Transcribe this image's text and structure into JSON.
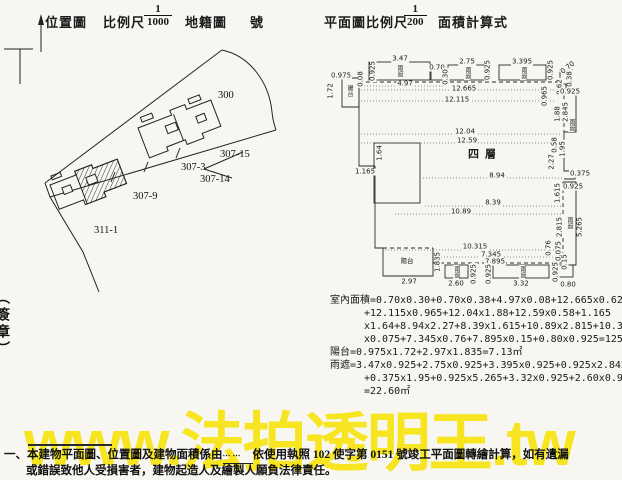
{
  "header": {
    "north_label": "N",
    "location_map_label": "位置圖",
    "scale_label": "比例尺",
    "scale1": {
      "num": "1",
      "den": "1000"
    },
    "cadastral_label": "地籍圖",
    "number_label": "號",
    "plan_scale_label": "平面圖比例尺",
    "scale2": {
      "num": "1",
      "den": "200"
    },
    "area_calc_label": "面積計算式"
  },
  "site_map": {
    "parcels": [
      "300",
      "307-15",
      "307-14",
      "307-3",
      "307-9",
      "311-1"
    ]
  },
  "floor_plan": {
    "floor_label": "四層",
    "labels": [
      {
        "t": "0.975",
        "x": 16,
        "y": 21,
        "k": "h"
      },
      {
        "t": "1.72",
        "x": 6,
        "y": 36,
        "k": "v"
      },
      {
        "t": "陽台",
        "x": 24,
        "y": 36,
        "k": "c"
      },
      {
        "t": "0.08",
        "x": 36,
        "y": 24,
        "k": "v"
      },
      {
        "t": "0.925",
        "x": 48,
        "y": 16,
        "k": "v"
      },
      {
        "t": "3.47",
        "x": 75,
        "y": 4,
        "k": "h"
      },
      {
        "t": "雨遮",
        "x": 74,
        "y": 16,
        "k": "c"
      },
      {
        "t": "4.97",
        "x": 80,
        "y": 29,
        "k": "h"
      },
      {
        "t": "0.70",
        "x": 112,
        "y": 13,
        "k": "h"
      },
      {
        "t": "0.30",
        "x": 121,
        "y": 22,
        "k": "v"
      },
      {
        "t": "2.75",
        "x": 142,
        "y": 7,
        "k": "h"
      },
      {
        "t": "雨遮",
        "x": 142,
        "y": 18,
        "k": "c"
      },
      {
        "t": "0.925",
        "x": 163,
        "y": 15,
        "k": "v"
      },
      {
        "t": "3.395",
        "x": 197,
        "y": 7,
        "k": "h"
      },
      {
        "t": "雨遮",
        "x": 198,
        "y": 18,
        "k": "c"
      },
      {
        "t": "0.925",
        "x": 226,
        "y": 15,
        "k": "v"
      },
      {
        "t": "0.70",
        "x": 243,
        "y": 13,
        "k": "d"
      },
      {
        "t": "0.38",
        "x": 245,
        "y": 24,
        "k": "v"
      },
      {
        "t": "12.665",
        "x": 139,
        "y": 34,
        "k": "h"
      },
      {
        "t": "12.115",
        "x": 132,
        "y": 45,
        "k": "h"
      },
      {
        "t": "0.62",
        "x": 235,
        "y": 32,
        "k": "v"
      },
      {
        "t": "0.965",
        "x": 220,
        "y": 41,
        "k": "v"
      },
      {
        "t": "0.925",
        "x": 245,
        "y": 37,
        "k": "h"
      },
      {
        "t": "1.88",
        "x": 233,
        "y": 59,
        "k": "v"
      },
      {
        "t": "2.845",
        "x": 241,
        "y": 57,
        "k": "v"
      },
      {
        "t": "雨遮",
        "x": 246,
        "y": 70,
        "k": "c"
      },
      {
        "t": "12.04",
        "x": 140,
        "y": 77,
        "k": "h"
      },
      {
        "t": "12.59",
        "x": 142,
        "y": 86,
        "k": "h"
      },
      {
        "t": "0.58",
        "x": 230,
        "y": 90,
        "k": "v"
      },
      {
        "t": "1.95",
        "x": 238,
        "y": 94,
        "k": "v"
      },
      {
        "t": "四層",
        "x": 160,
        "y": 99,
        "k": "big"
      },
      {
        "t": "2.27",
        "x": 227,
        "y": 107,
        "k": "v"
      },
      {
        "t": "0.375",
        "x": 255,
        "y": 119,
        "k": "h"
      },
      {
        "t": "0.925",
        "x": 248,
        "y": 132,
        "k": "h"
      },
      {
        "t": "1.64",
        "x": 55,
        "y": 98,
        "k": "v"
      },
      {
        "t": "1.165",
        "x": 40,
        "y": 117,
        "k": "h"
      },
      {
        "t": "8.94",
        "x": 172,
        "y": 121,
        "k": "h"
      },
      {
        "t": "1.615",
        "x": 233,
        "y": 138,
        "k": "v"
      },
      {
        "t": "8.39",
        "x": 168,
        "y": 148,
        "k": "h"
      },
      {
        "t": "10.89",
        "x": 136,
        "y": 157,
        "k": "h"
      },
      {
        "t": "2.815",
        "x": 235,
        "y": 172,
        "k": "v"
      },
      {
        "t": "雨遮",
        "x": 244,
        "y": 168,
        "k": "c"
      },
      {
        "t": "5.265",
        "x": 255,
        "y": 172,
        "k": "v"
      },
      {
        "t": "10.315",
        "x": 150,
        "y": 192,
        "k": "h"
      },
      {
        "t": "0.76",
        "x": 224,
        "y": 193,
        "k": "v"
      },
      {
        "t": "0.075",
        "x": 234,
        "y": 196,
        "k": "v"
      },
      {
        "t": "7.345",
        "x": 166,
        "y": 200,
        "k": "h"
      },
      {
        "t": "7.895",
        "x": 170,
        "y": 207,
        "k": "h"
      },
      {
        "t": "0.15",
        "x": 240,
        "y": 207,
        "k": "v"
      },
      {
        "t": "陽台",
        "x": 82,
        "y": 206,
        "k": "hc"
      },
      {
        "t": "1.835",
        "x": 113,
        "y": 207,
        "k": "v"
      },
      {
        "t": "2.97",
        "x": 84,
        "y": 227,
        "k": "h"
      },
      {
        "t": "雨遮",
        "x": 131,
        "y": 217,
        "k": "c"
      },
      {
        "t": "2.60",
        "x": 131,
        "y": 229,
        "k": "h"
      },
      {
        "t": "0.925",
        "x": 149,
        "y": 219,
        "k": "v"
      },
      {
        "t": "0.925",
        "x": 164,
        "y": 219,
        "k": "v"
      },
      {
        "t": "雨遮",
        "x": 197,
        "y": 217,
        "k": "c"
      },
      {
        "t": "3.32",
        "x": 196,
        "y": 229,
        "k": "h"
      },
      {
        "t": "0.925",
        "x": 231,
        "y": 217,
        "k": "v"
      },
      {
        "t": "0.80",
        "x": 243,
        "y": 230,
        "k": "h"
      }
    ]
  },
  "calculations": {
    "lines": [
      {
        "text": "室內面積=0.70x0.30+0.70x0.38+4.97x0.08+12.665x0.62",
        "indent": false
      },
      {
        "text": "+12.115x0.965+12.04x1.88+12.59x0.58+1.165",
        "indent": true
      },
      {
        "text": "x1.64+8.94x2.27+8.39x1.615+10.89x2.815+10.315",
        "indent": true
      },
      {
        "text": "x0.075+7.345x0.76+7.895x0.15+0.80x0.925=125.",
        "indent": true
      },
      {
        "text": "陽台=0.975x1.72+2.97x1.835=7.13㎡",
        "indent": false
      },
      {
        "text": "雨遮=3.47x0.925+2.75x0.925+3.395x0.925+0.925x2.845",
        "indent": false
      },
      {
        "text": "+0.375x1.95+0.925x5.265+3.32x0.925+2.60x0.925",
        "indent": true
      },
      {
        "text": "=22.60㎡",
        "indent": true
      }
    ]
  },
  "watermark": {
    "text": "www.法拍透明王.tw",
    "color": "#f6e40a"
  },
  "footnote": {
    "item_no": "一、",
    "part1": "本建物平面圖、位置圖及建物面積係由",
    "blank": "⋯⋯",
    "part2": "依使用執照 102 使字第 0151 號竣工平面圖轉繪計算，如有遺漏",
    "line2": "或錯誤致他人受損害者，建物起造人及繪製人願負法律責任。"
  },
  "left_edge_text": "（簽章）"
}
